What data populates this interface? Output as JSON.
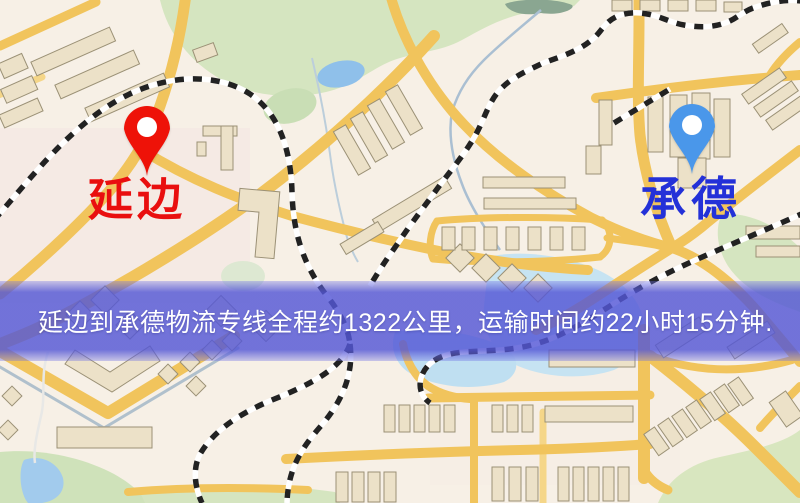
{
  "banner": {
    "text": "延边到承德物流专线全程约1322公里，运输时间约22小时15分钟.",
    "background_color": "#5457d6",
    "text_color": "#ffffff"
  },
  "markers": {
    "origin": {
      "label": "延边",
      "pin_color": "#ee1208",
      "label_color": "#e90f0f"
    },
    "destination": {
      "label": "承德",
      "pin_color": "#4a97ea",
      "label_color": "#2431d8"
    }
  },
  "route_info": {
    "origin": "延边",
    "destination": "承德",
    "service_type": "物流专线",
    "total_distance": "约1322公里",
    "transport_time": "约22小时15分钟"
  },
  "map_palette": {
    "background": "#f7f0e6",
    "road": "#f1c45c",
    "park": "#d5e5c0",
    "water": "#9cc7ee",
    "building": "#ece1c8",
    "railway": "#222222",
    "banner_overlay": "#5457d6"
  }
}
